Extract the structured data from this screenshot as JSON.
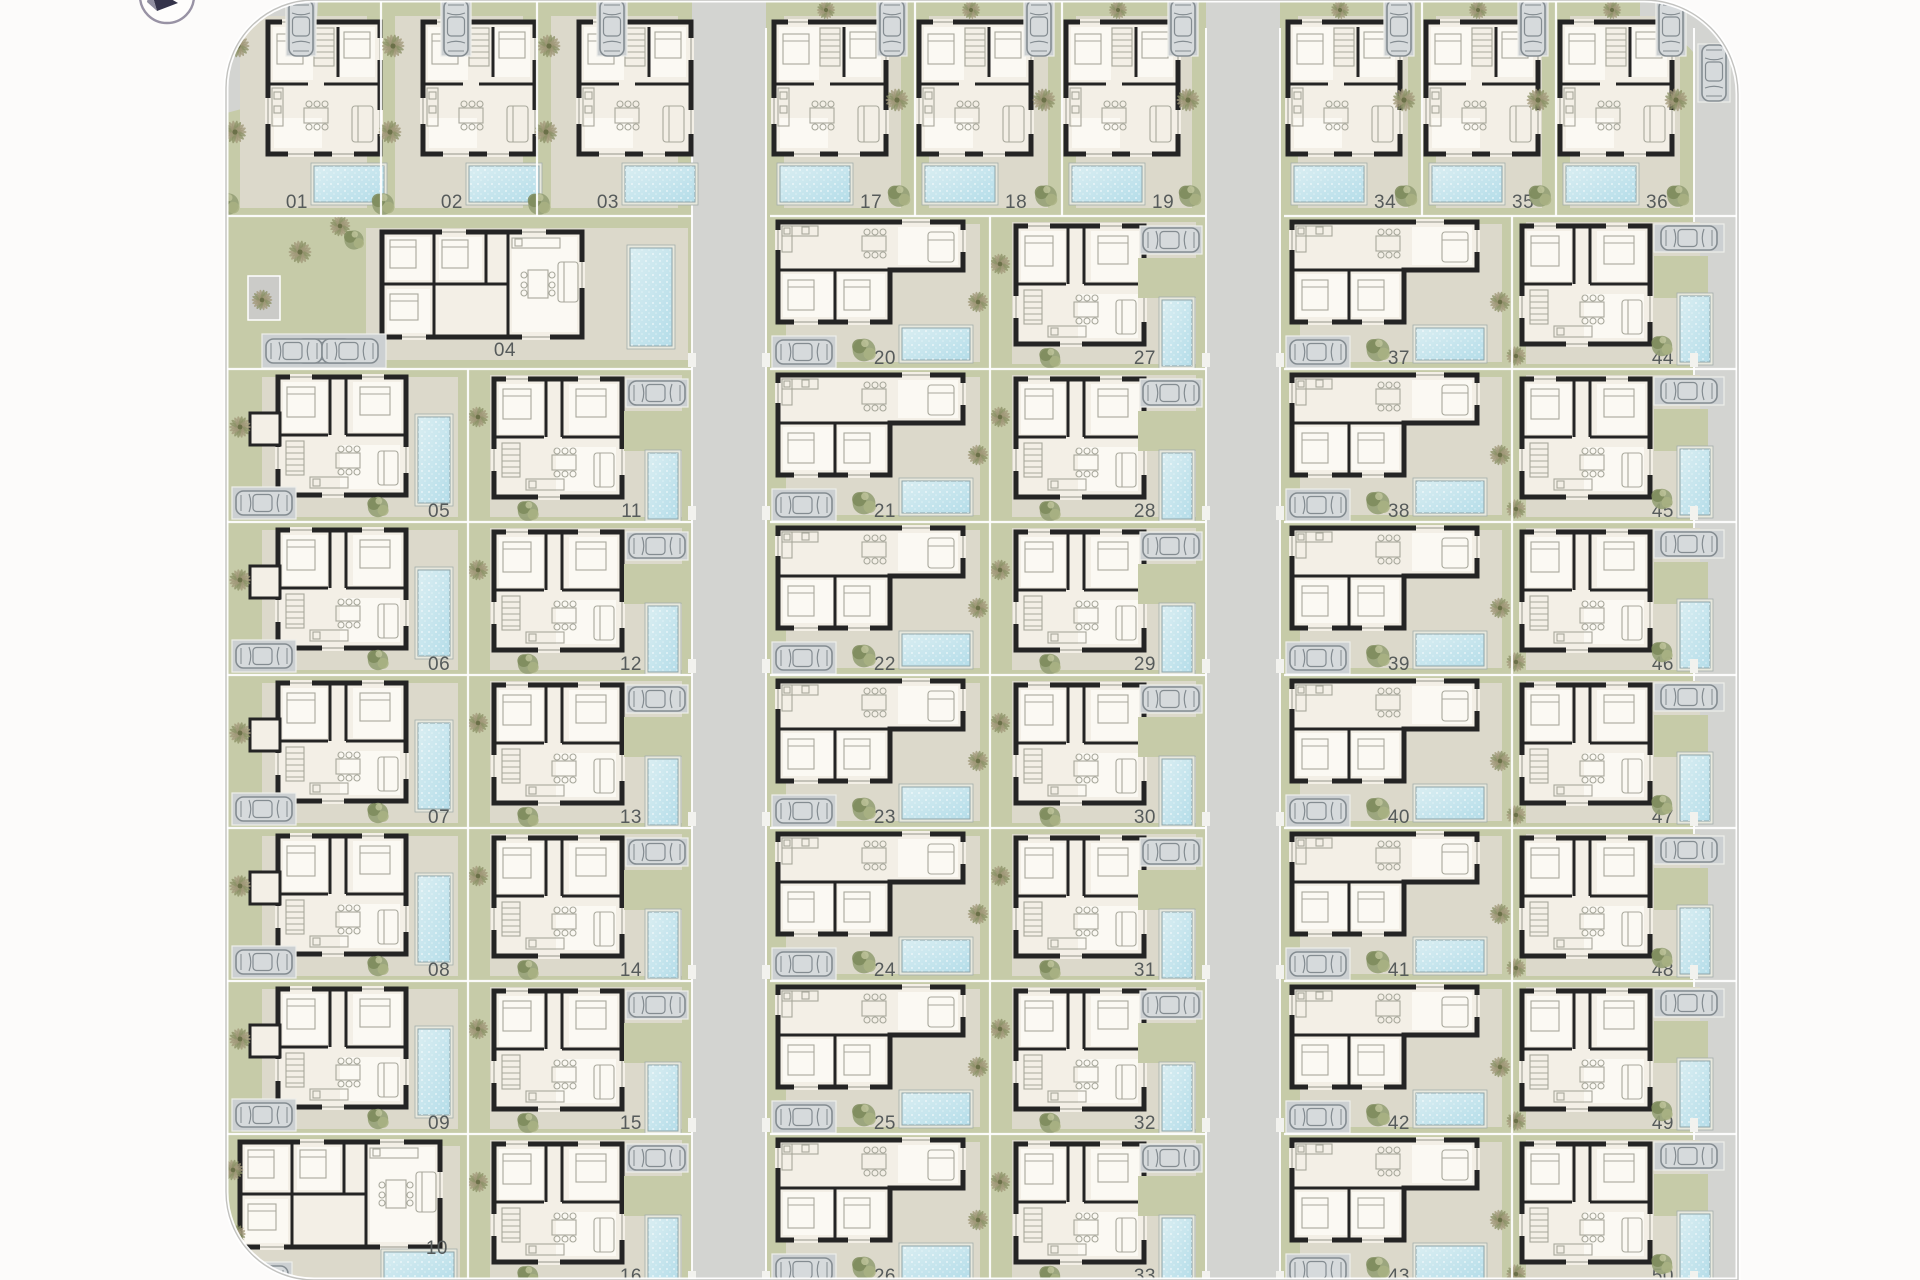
{
  "plan": {
    "title": "residential-villas-site-plan",
    "compass": {
      "icon": "north-arrow"
    },
    "colors": {
      "background": "#fcfbfa",
      "road": "#d3d4d1",
      "grass": "#c6cba8",
      "patio": "#dcd9cb",
      "house_floor": "#f3efe6",
      "room_white": "#fbf9f3",
      "wall": "#242424",
      "pool_light": "#daeef2",
      "pool_dark": "#b5dde9",
      "pool_rim": "#e7e8dd",
      "pool_edge": "#8fa5a9",
      "label": "#565b5b",
      "boundary": "#ffffff",
      "boundary_edge": "#c2c2bf",
      "pad": "#ccd0d2",
      "car_body": "#d6dadc",
      "car_line": "#848c91",
      "furniture": "#a8a89c",
      "tree_dark": "#7d8a5a",
      "tree_mid": "#95a075",
      "tree_light": "#a9b183",
      "palm_green": "#8c9166",
      "palm_brown": "#a2997a",
      "utility_box": "#cbcbc8",
      "compass_ring": "#9892a4",
      "compass_needle": "#34334a"
    },
    "blocks": {
      "left_top_row": [
        "01",
        "02",
        "03"
      ],
      "left_bungalow": "04",
      "left_col_outer": [
        "05",
        "06",
        "07",
        "08",
        "09",
        "10"
      ],
      "left_col_inner": [
        "11",
        "12",
        "13",
        "14",
        "15",
        "16"
      ],
      "mid_top_row": [
        "17",
        "18",
        "19"
      ],
      "mid_col_left": [
        "20",
        "21",
        "22",
        "23",
        "24",
        "25",
        "26"
      ],
      "mid_col_right": [
        "27",
        "28",
        "29",
        "30",
        "31",
        "32",
        "33"
      ],
      "right_top_row": [
        "34",
        "35",
        "36"
      ],
      "right_col_left": [
        "37",
        "38",
        "39",
        "40",
        "41",
        "42",
        "43"
      ],
      "right_col_right": [
        "44",
        "45",
        "46",
        "47",
        "48",
        "49",
        "50"
      ]
    }
  }
}
